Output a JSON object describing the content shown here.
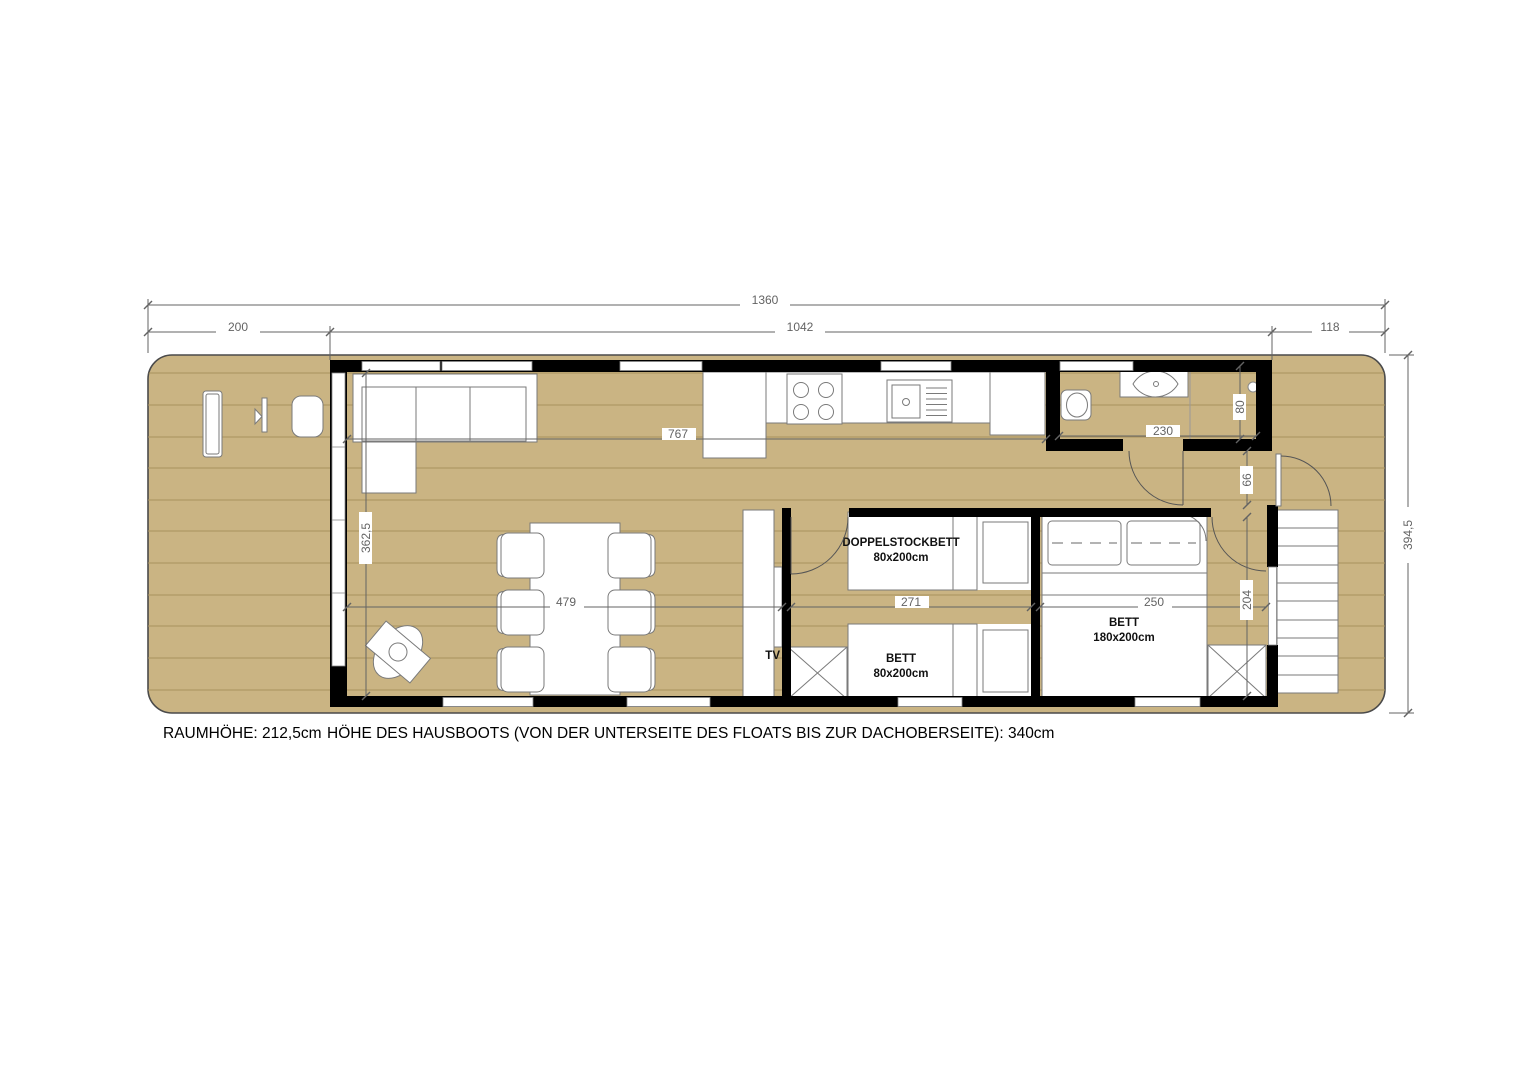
{
  "dims": {
    "total": "1360",
    "terrace": "200",
    "cabin": "1042",
    "aft": "118",
    "beam": "394,5",
    "living_w": "362,5",
    "living_l": "479",
    "kitchen": "767",
    "bath": "230",
    "shower": "80",
    "hall": "66",
    "kids": "271",
    "master_l": "250",
    "master_w": "204"
  },
  "labels": {
    "bunk_bed": "DOPPELSTOCKBETT",
    "bunk_bed_size": "80x200cm",
    "single_bed": "BETT",
    "single_bed_size": "80x200cm",
    "master_bed": "BETT",
    "master_bed_size": "180x200cm",
    "tv": "TV"
  },
  "notes": {
    "room_height": "RAUMHÖHE: 212,5cm",
    "boat_height": "HÖHE DES HAUSBOOTS (VON DER UNTERSEITE DES FLOATS BIS ZUR DACHOBERSEITE): 340cm"
  },
  "colors": {
    "floor": "#cab483",
    "plank": "#a8925e",
    "wall": "#000000",
    "hullstroke": "#4a4a4a",
    "furn": "#7a7a7a",
    "dim": "#636363"
  }
}
